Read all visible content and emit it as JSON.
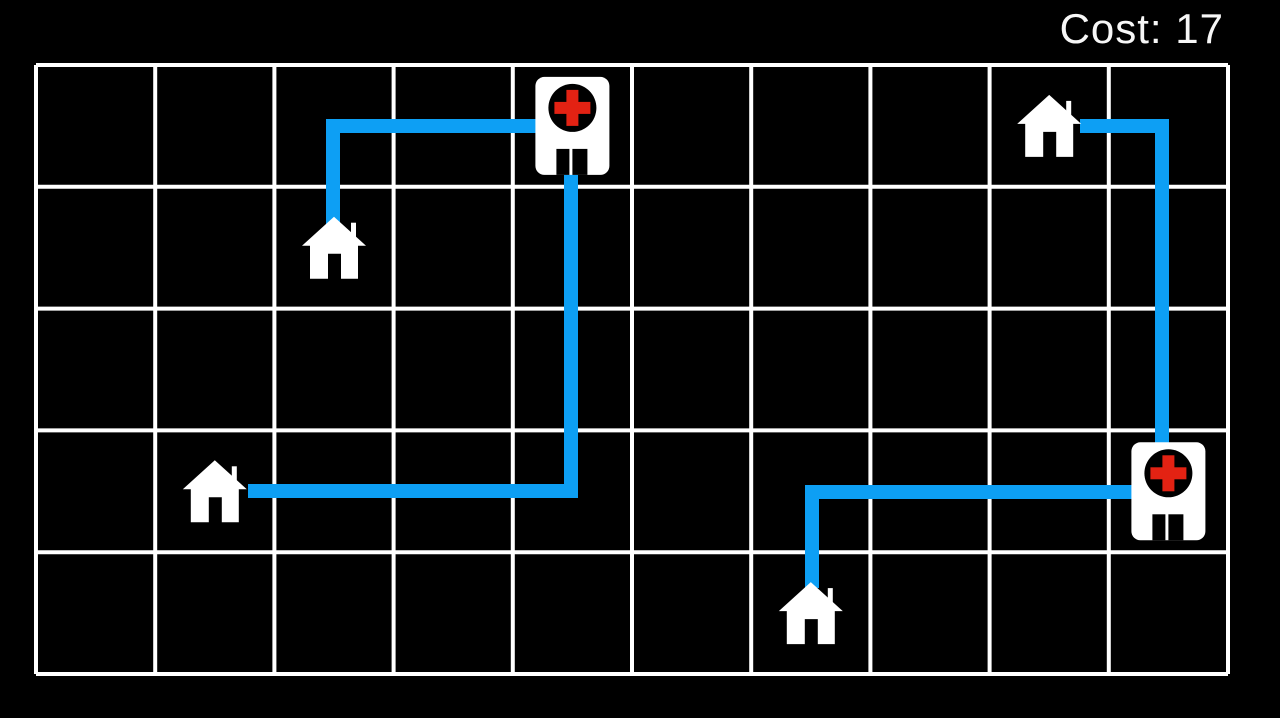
{
  "hud": {
    "cost_text": "Cost: 17",
    "cost_value": 17
  },
  "palette": {
    "background": "#000000",
    "grid_line": "#ffffff",
    "route_blue": "#0d9ff4",
    "icon_white": "#ffffff",
    "icon_black": "#000000",
    "cross_red": "#e32213",
    "hud_text": "#f7f7f7"
  },
  "board": {
    "cols": 10,
    "rows": 5,
    "x": 36,
    "y": 65,
    "width": 1192,
    "height": 609,
    "grid_line_width": 4
  },
  "houses": [
    {
      "id": "house-1",
      "col": 2,
      "row": 1
    },
    {
      "id": "house-2",
      "col": 8,
      "row": 0
    },
    {
      "id": "house-3",
      "col": 1,
      "row": 3
    },
    {
      "id": "house-4",
      "col": 6,
      "row": 4
    }
  ],
  "hospitals": [
    {
      "id": "hospital-1",
      "col": 4,
      "row": 0
    },
    {
      "id": "hospital-2",
      "col": 9,
      "row": 3
    }
  ],
  "routes": [
    {
      "id": "route-house1-hospital1",
      "cost": 3,
      "width": 14,
      "points": [
        [
          333,
          226
        ],
        [
          333,
          126
        ],
        [
          545,
          126
        ]
      ]
    },
    {
      "id": "route-house3-hospital1",
      "cost": 6,
      "width": 14,
      "points": [
        [
          248,
          491
        ],
        [
          571,
          491
        ],
        [
          571,
          168
        ]
      ]
    },
    {
      "id": "route-house2-hospital2",
      "cost": 4,
      "width": 14,
      "points": [
        [
          1080,
          126
        ],
        [
          1162,
          126
        ],
        [
          1162,
          450
        ]
      ]
    },
    {
      "id": "route-house4-hospital2",
      "cost": 4,
      "width": 14,
      "points": [
        [
          812,
          588
        ],
        [
          812,
          492
        ],
        [
          1135,
          492
        ]
      ]
    }
  ]
}
